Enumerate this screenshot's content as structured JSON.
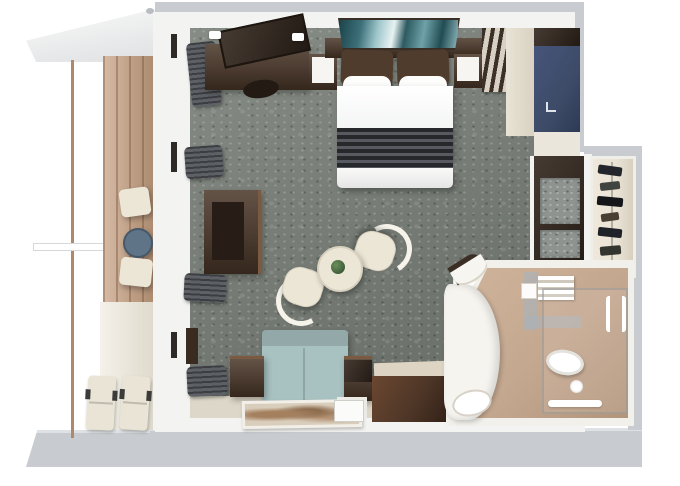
{
  "scene": {
    "type": "3d-floor-plan-render",
    "view": "top-down-isometric",
    "rooms": [
      {
        "id": "balcony",
        "label": "Balcony"
      },
      {
        "id": "bedroom-living",
        "label": "Bedroom and Living Area"
      },
      {
        "id": "walk-in-closet",
        "label": "Walk-in Closet"
      },
      {
        "id": "bathroom",
        "label": "Bathroom"
      }
    ],
    "furniture": {
      "balcony": [
        "deck-chair",
        "round-table",
        "deck-chair",
        "sun-lounger",
        "sun-lounger"
      ],
      "bedroom_living": [
        "tv-console",
        "wall-tv",
        "desk-stool",
        "nightstand",
        "king-bed",
        "wall-art",
        "nightstand",
        "luggage-rack",
        "vanity-desk",
        "window-curtains",
        "wall-desk",
        "dining-table",
        "potted-plant",
        "dining-chair",
        "dining-chair",
        "sofa",
        "side-table",
        "side-table",
        "floor-art-rug",
        "credenza",
        "papers"
      ],
      "closet": [
        "wardrobe-shelves",
        "hanging-clothes"
      ],
      "bathroom": [
        "towel-shelf",
        "glass-shower",
        "towel-bar",
        "toilet",
        "vanity-basin",
        "entry-steps"
      ]
    },
    "colors": {
      "background": "#ffffff",
      "outer_wall": "#c8cbcf",
      "outer_wall_edge": "#dfe2e4",
      "inner_wall": "#f3f3f1",
      "cream_wall": "#e9e3d6",
      "floor_strip": "#dcd7c8",
      "carpet": "#798078",
      "carpet_speck": "#8e938f",
      "dark_wood": "#4a3628",
      "darker_wood": "#31251c",
      "wood_highlight": "#7a5a40",
      "balcony_wood": "#c59e7e",
      "deck_light": "#e9e4d5",
      "bathroom_floor": "#c4a78f",
      "tile_blue": "#a9b2ba",
      "sofa": "#a8c1c1",
      "navy": "#3d4b68",
      "cream_furniture": "#ece6d7",
      "chair_ring": "#f6f3eb",
      "art_teal_dark": "#1d454d",
      "art_teal_light": "#e8f2f2",
      "throw_dark": "#26282c",
      "throw_light": "#575a60",
      "plant_green": "#47663f",
      "table_blue": "#5f7486",
      "curtain": "#5d6065",
      "curtain_dark": "#3c3e43",
      "rug_tan": "#d9cdbb",
      "rug_tan_dark": "#8a6a4c",
      "toilet_white": "#ffffff",
      "glass_edge": "rgba(150,150,148,0.55)"
    }
  }
}
